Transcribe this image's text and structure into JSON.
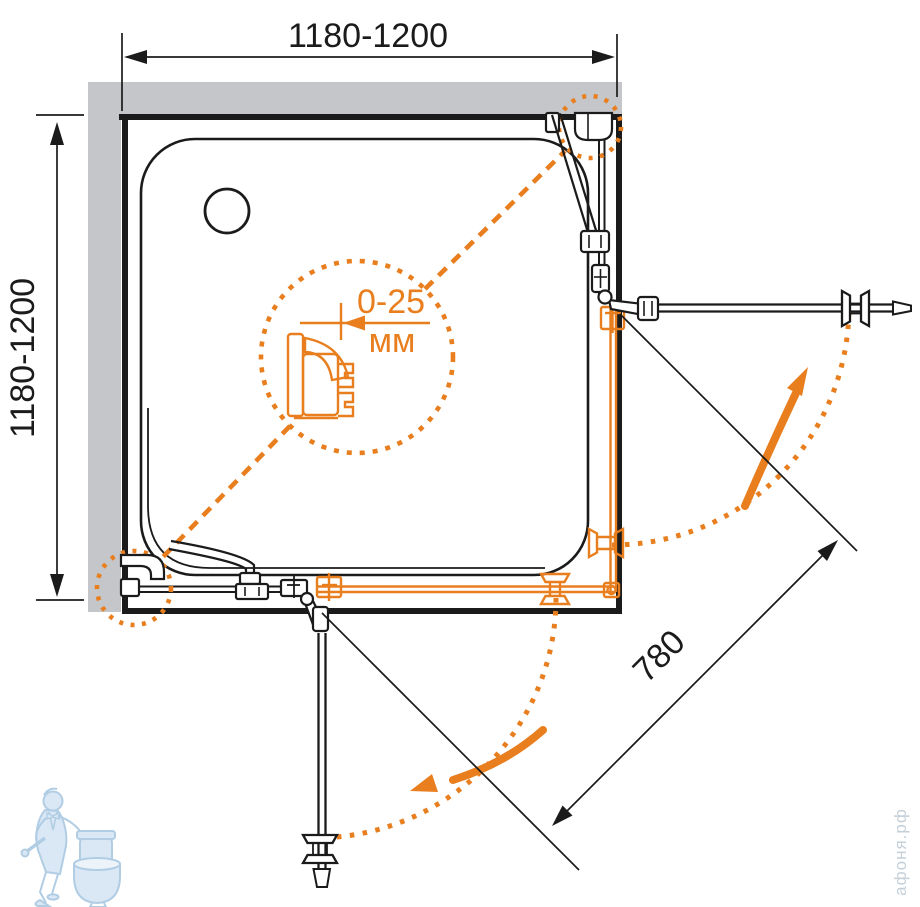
{
  "drawing": {
    "dim_top": "1180-1200",
    "dim_left": "1180-1200",
    "dim_diagonal": "780",
    "detail_range": "0-25",
    "detail_unit": "мм",
    "watermark_text": "афоня.рф"
  },
  "colors": {
    "accent_orange": "#E87E1E",
    "wall_gray": "#C5C6C9",
    "line_black": "#1B1B1B",
    "watermark_blue": "#A9C8E2",
    "watermark_fill": "#D6E6F4",
    "watermark_text_color": "#C4CFD8"
  }
}
